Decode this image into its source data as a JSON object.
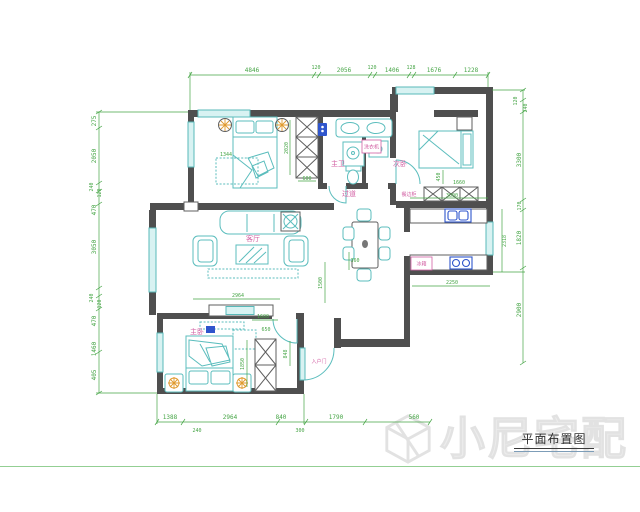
{
  "drawing": {
    "title": "平面布置图",
    "watermark": "小尼宅配"
  },
  "rooms": {
    "living": "客厅",
    "master_bedroom": "主卧",
    "second_bedroom": "次卧",
    "master_bath": "主卫",
    "hallway": "过道",
    "sideboard_cabinet": "餐边柜",
    "entry_door": "入户门",
    "washing_machine": "洗衣机",
    "fridge": "冰箱"
  },
  "dims": {
    "top": [
      "4846",
      "120",
      "2056",
      "120",
      "1406",
      "128",
      "1676",
      "1228"
    ],
    "left": [
      "275",
      "2050",
      "240",
      "120",
      "470",
      "3050",
      "240",
      "120",
      "470",
      "1460",
      "405"
    ],
    "right": [
      "120",
      "240",
      "3300",
      "170",
      "1820",
      "2900"
    ],
    "bottom": [
      "1388",
      "2964",
      "840",
      "1790",
      "560",
      "240",
      "300"
    ],
    "inner": [
      "2020",
      "600",
      "1344",
      "450",
      "1660",
      "3000",
      "2318",
      "2250",
      "360",
      "1500",
      "2964",
      "1600",
      "650",
      "1850",
      "848"
    ]
  },
  "colors": {
    "wall": "#4f4f4f",
    "furniture": "#5bbdbd",
    "dimension": "#46a546",
    "room_label": "#d25fa3",
    "fixture_blue": "#2f55cc",
    "lamp_orange": "#e09a2e",
    "watermark": "#ececec",
    "frame_line": "#93cf93"
  }
}
